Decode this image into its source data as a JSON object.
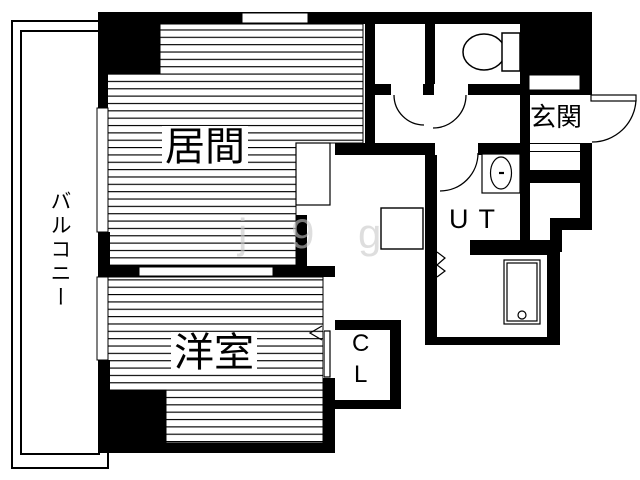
{
  "plan": {
    "title": "apartment floor plan",
    "rooms": {
      "balcony": {
        "label": "バルコニー"
      },
      "living": {
        "label": "居間"
      },
      "bedroom": {
        "label": "洋室"
      },
      "entrance": {
        "label": "玄関"
      },
      "utility": {
        "label": "UT"
      },
      "closet": {
        "label": "CL"
      }
    },
    "fixtures": [
      "toilet-icon",
      "washbasin-icon",
      "bathtub-icon",
      "kitchen-counter",
      "washer-pan",
      "shoe-cabinet",
      "door-swing-arcs",
      "folding-doors",
      "windows"
    ],
    "watermark": "j 9 g",
    "colors": {
      "wall": "#000000",
      "floor": "#ffffff",
      "stripe": "#000000",
      "watermark": "#c9c9c9"
    }
  }
}
